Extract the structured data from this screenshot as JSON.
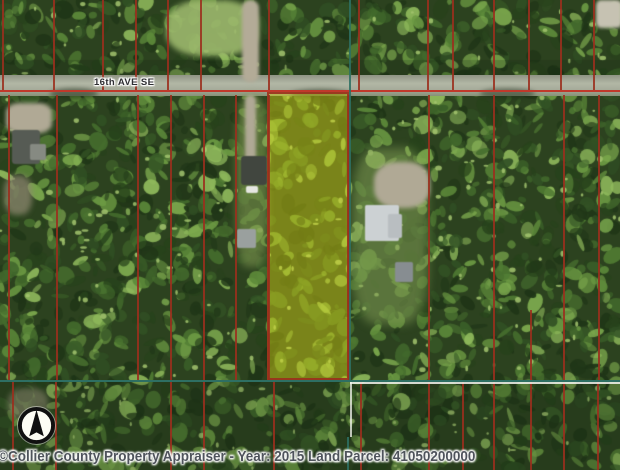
{
  "map": {
    "road_label": "16th AVE SE",
    "caption": "©Collier County Property Appraiser  - Year: 2015 Land Parcel: 41050200000",
    "year": "2015",
    "parcel_id": "41050200000",
    "highlighted_parcel": {
      "x": 267,
      "y": 92,
      "w": 82,
      "h": 288
    },
    "colors": {
      "parcel_line": "#9b2f1e",
      "road_line": "#c0392b",
      "section_line": "#2e6f63",
      "white_line": "rgba(245,245,240,0.85)",
      "highlight_fill": "rgba(230,224,20,0.42)",
      "highlight_border": "rgba(155,47,30,0.9)",
      "caption_color": "#4f545c",
      "road_label_color": "#2f2f33",
      "foliage_palette": [
        "#1f3517",
        "#27421b",
        "#315024",
        "#3a5e28",
        "#446c2d",
        "#507b33",
        "#5d8a3a",
        "#6c9a43",
        "#7daa4e",
        "#90ba5c"
      ],
      "foliage_base": "#2c421f",
      "foliage_highlight": "#a3c46f"
    },
    "road": {
      "y": 75,
      "h": 21,
      "red_line_y": 90
    },
    "lines": {
      "vertical_groups": [
        {
          "name": "parcel-lines-north",
          "y0": 0,
          "y1": 90,
          "xs": [
            2,
            53,
            102,
            135,
            167,
            200,
            268,
            358,
            427,
            452,
            493,
            528,
            560,
            593
          ]
        },
        {
          "name": "parcel-lines-south",
          "y0": 95,
          "y1": 381,
          "xs": [
            8,
            56,
            137,
            170,
            203,
            235,
            268,
            348,
            428,
            493,
            563,
            598
          ]
        },
        {
          "name": "parcel-lines-south-partial",
          "y0": 310,
          "y1": 381,
          "xs": [
            530
          ]
        },
        {
          "name": "parcel-lines-bottom",
          "y0": 381,
          "y1": 470,
          "xs": [
            12,
            55,
            170,
            203,
            273,
            360,
            428,
            462,
            493,
            530,
            563,
            597
          ]
        }
      ],
      "section": {
        "vertical_x": 349,
        "vertical_y0": 0,
        "vertical_y1": 381,
        "horizontal_y": 380,
        "white_h": {
          "x0": 350,
          "x1": 620,
          "y": 382
        },
        "white_v": {
          "x": 350,
          "y0": 382,
          "y1": 437
        },
        "teal_v_bottom": {
          "x": 347,
          "y0": 437,
          "y1": 470
        }
      }
    },
    "features": [
      {
        "name": "clearing-grass-top",
        "x": 166,
        "y": 0,
        "w": 92,
        "h": 56,
        "color": "#9db96d",
        "blur": 3,
        "radius": "40%",
        "opacity": 0.9
      },
      {
        "name": "dirt-path-top",
        "x": 242,
        "y": 0,
        "w": 17,
        "h": 82,
        "color": "#b3ab97",
        "blur": 1.5,
        "radius": "8px",
        "opacity": 1
      },
      {
        "name": "clearing-top-right",
        "x": 596,
        "y": 0,
        "w": 26,
        "h": 28,
        "color": "#c6c2b2",
        "blur": 1.5,
        "radius": "20%",
        "opacity": 1
      },
      {
        "name": "driveway-west",
        "x": 6,
        "y": 103,
        "w": 46,
        "h": 30,
        "color": "#b0a995",
        "blur": 2,
        "radius": "30%",
        "opacity": 1
      },
      {
        "name": "house-west",
        "x": 12,
        "y": 130,
        "w": 28,
        "h": 34,
        "color": "#565b54",
        "blur": 0.5,
        "radius": "3px",
        "opacity": 1
      },
      {
        "name": "house-west-small",
        "x": 30,
        "y": 144,
        "w": 16,
        "h": 16,
        "color": "#868a82",
        "blur": 0.5,
        "radius": "2px",
        "opacity": 1
      },
      {
        "name": "dirt-west-lower",
        "x": 4,
        "y": 175,
        "w": 28,
        "h": 40,
        "color": "#8d876f",
        "blur": 3,
        "radius": "40%",
        "opacity": 0.75
      },
      {
        "name": "lawn-mid",
        "x": 236,
        "y": 95,
        "w": 32,
        "h": 172,
        "color": "#7d964f",
        "blur": 4,
        "radius": "30%",
        "opacity": 0.6
      },
      {
        "name": "driveway-mid",
        "x": 245,
        "y": 95,
        "w": 11,
        "h": 68,
        "color": "#b0a995",
        "blur": 1.5,
        "radius": "6px",
        "opacity": 1
      },
      {
        "name": "house-mid",
        "x": 241,
        "y": 156,
        "w": 26,
        "h": 29,
        "color": "#41463f",
        "blur": 0.5,
        "radius": "3px",
        "opacity": 1
      },
      {
        "name": "vehicle-mid",
        "x": 246,
        "y": 186,
        "w": 12,
        "h": 7,
        "color": "#e5e6e1",
        "blur": 0.5,
        "radius": "2px",
        "opacity": 1
      },
      {
        "name": "shed-mid",
        "x": 237,
        "y": 229,
        "w": 19,
        "h": 19,
        "color": "#9aa09e",
        "blur": 0.5,
        "radius": "2px",
        "opacity": 1
      },
      {
        "name": "lawn-east",
        "x": 352,
        "y": 148,
        "w": 76,
        "h": 176,
        "color": "#829e55",
        "blur": 5,
        "radius": "30%",
        "opacity": 0.55
      },
      {
        "name": "driveway-east",
        "x": 374,
        "y": 162,
        "w": 56,
        "h": 46,
        "color": "#b0a995",
        "blur": 2,
        "radius": "40%",
        "opacity": 1
      },
      {
        "name": "house-east",
        "x": 365,
        "y": 205,
        "w": 34,
        "h": 36,
        "color": "#ccd1d3",
        "blur": 0.5,
        "radius": "2px",
        "opacity": 1
      },
      {
        "name": "house-east-wing",
        "x": 388,
        "y": 214,
        "w": 14,
        "h": 24,
        "color": "#b9bec1",
        "blur": 0.5,
        "radius": "2px",
        "opacity": 1
      },
      {
        "name": "shed-east",
        "x": 395,
        "y": 262,
        "w": 18,
        "h": 20,
        "color": "#878d91",
        "blur": 0.5,
        "radius": "2px",
        "opacity": 1
      },
      {
        "name": "dirt-bottom-left",
        "x": 8,
        "y": 388,
        "w": 40,
        "h": 32,
        "color": "#8c8770",
        "blur": 3,
        "radius": "40%",
        "opacity": 0.55
      },
      {
        "name": "tree-shadow-road-1",
        "x": 50,
        "y": 88,
        "w": 48,
        "h": 11,
        "color": "rgba(28,44,24,0.5)",
        "blur": 2,
        "radius": "50%",
        "opacity": 1
      },
      {
        "name": "tree-shadow-road-2",
        "x": 290,
        "y": 89,
        "w": 60,
        "h": 10,
        "color": "rgba(28,44,24,0.5)",
        "blur": 2,
        "radius": "50%",
        "opacity": 1
      },
      {
        "name": "tree-shadow-road-3",
        "x": 480,
        "y": 88,
        "w": 55,
        "h": 11,
        "color": "rgba(28,44,24,0.45)",
        "blur": 2,
        "radius": "50%",
        "opacity": 1
      }
    ],
    "compass": {
      "x": 17,
      "y": 406,
      "size": 39
    }
  }
}
